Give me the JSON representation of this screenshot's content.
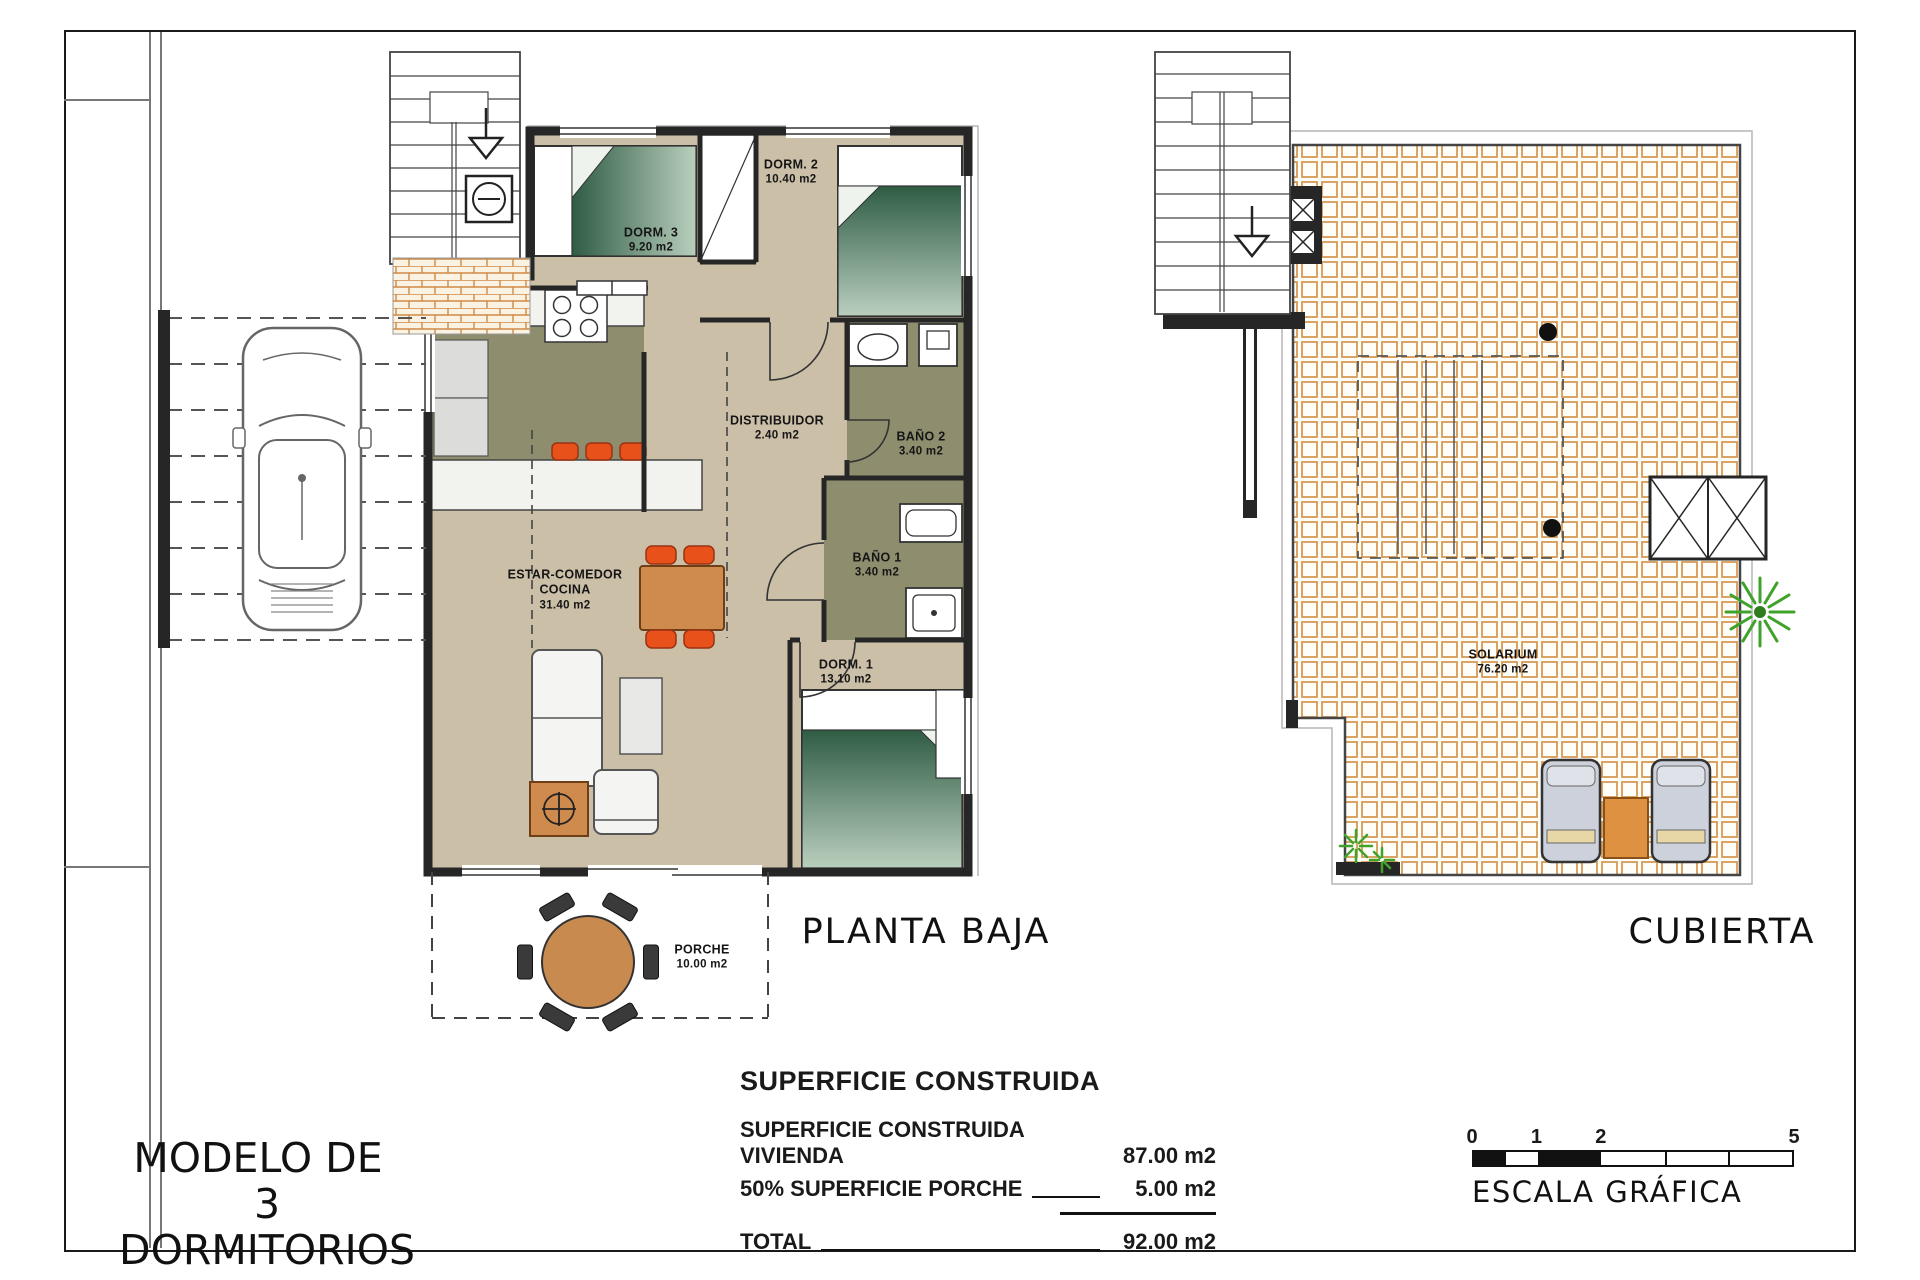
{
  "titles": {
    "model_line1": "MODELO DE",
    "model_line2": "3 DORMITORIOS",
    "ground_floor": "PLANTA BAJA",
    "roof": "CUBIERTA"
  },
  "rooms": {
    "dorm3": {
      "name": "DORM. 3",
      "area": "9.20 m2"
    },
    "dorm2": {
      "name": "DORM. 2",
      "area": "10.40 m2"
    },
    "distribuidor": {
      "name": "DISTRIBUIDOR",
      "area": "2.40 m2"
    },
    "bano2": {
      "name": "BAÑO 2",
      "area": "3.40 m2"
    },
    "bano1": {
      "name": "BAÑO 1",
      "area": "3.40 m2"
    },
    "dorm1": {
      "name": "DORM. 1",
      "area": "13.10 m2"
    },
    "estar_comedor": {
      "name": "ESTAR-COMEDOR",
      "name2": "COCINA",
      "area": "31.40 m2"
    },
    "porche": {
      "name": "PORCHE",
      "area": "10.00 m2"
    },
    "solarium": {
      "name": "SOLARIUM",
      "area": "76.20 m2"
    }
  },
  "area_table": {
    "heading": "SUPERFICIE CONSTRUIDA",
    "rows": [
      {
        "label": "SUPERFICIE CONSTRUIDA VIVIENDA",
        "value": "87.00 m2"
      },
      {
        "label": "50% SUPERFICIE PORCHE",
        "value": "5.00 m2"
      }
    ],
    "total": {
      "label": "TOTAL",
      "value": "92.00 m2"
    }
  },
  "scale_bar": {
    "label": "ESCALA GRÁFICA",
    "ticks": [
      "0",
      "1",
      "2",
      "5"
    ]
  },
  "colors": {
    "floor_tan": "#cbbfa8",
    "wet_room_olive": "#8e8e6f",
    "furniture_orange": "#e8521a",
    "wood_brown": "#c98a50",
    "roof_tile_line": "#d59a55",
    "plant_green": "#3fa32a",
    "wall_black": "#262626"
  }
}
